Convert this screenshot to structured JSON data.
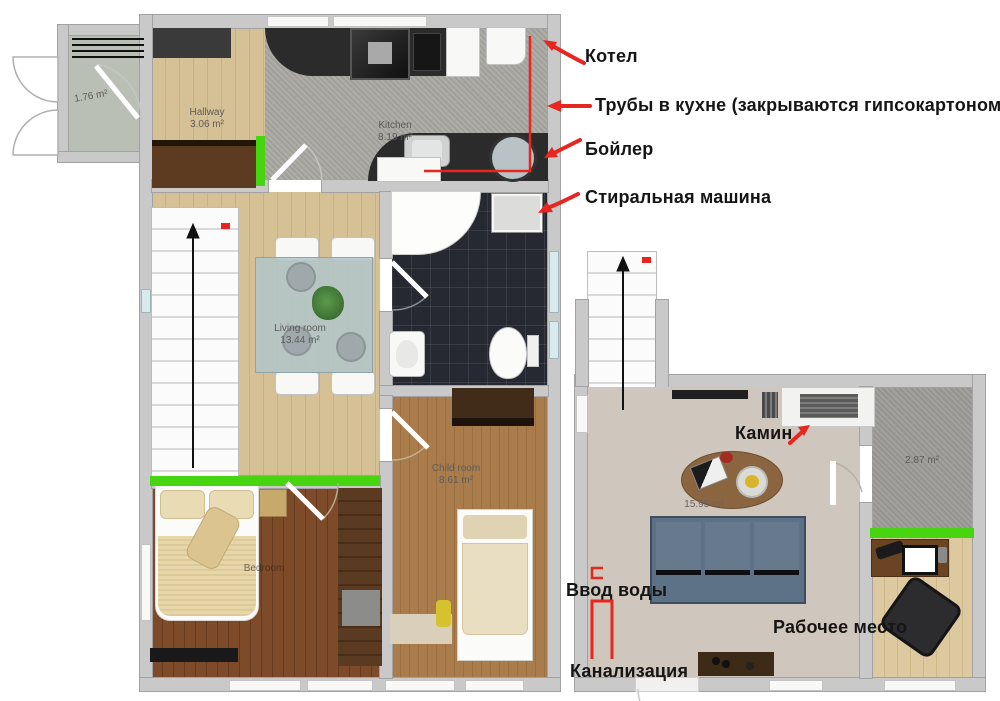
{
  "annotations": {
    "kotel": "Котел",
    "pipes": "Трубы в кухне (закрываются гипсокартоном)",
    "boyler": "Бойлер",
    "washer": "Стиральная машина",
    "fireplace": "Камин",
    "water_inlet": "Ввод воды",
    "workplace": "Рабочее место",
    "sewage": "Канализация"
  },
  "rooms": {
    "vestibule": {
      "area": "1.76 m²"
    },
    "hallway": {
      "name": "Hallway",
      "area": "3.06 m²"
    },
    "kitchen": {
      "name": "Kitchen",
      "area": "8.19 m²"
    },
    "living": {
      "name": "Living room",
      "area": "13.44 m²"
    },
    "child": {
      "name": "Child room",
      "area": "8.61 m²"
    },
    "bedroom": {
      "name": "Bedroom"
    },
    "upstairs": {
      "area": "15.95 m²"
    },
    "storage": {
      "area": "2.87 m²"
    }
  },
  "colors": {
    "annotation_red": "#e8251f",
    "highlight_green": "#47d411",
    "wall_gray": "#c9c9c9",
    "bath_tile": "#262932",
    "sofa_blue": "#5d7187"
  }
}
